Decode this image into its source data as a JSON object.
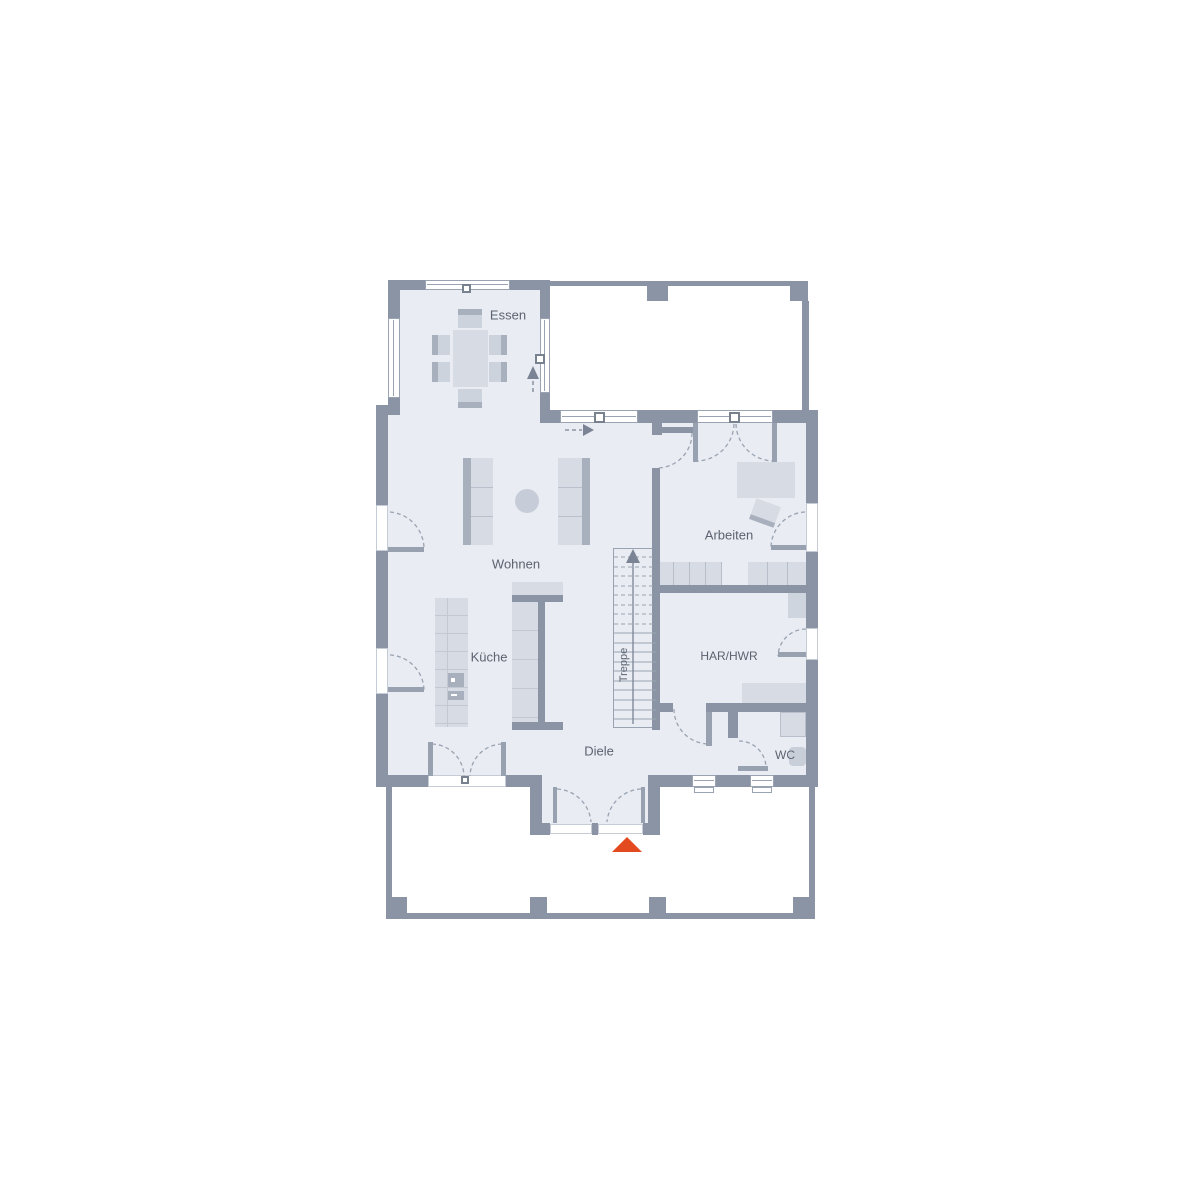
{
  "plan": {
    "rooms": {
      "essen": "Essen",
      "wohnen": "Wohnen",
      "kueche": "Küche",
      "arbeiten": "Arbeiten",
      "har_hwr": "HAR/HWR",
      "wc": "WC",
      "diele": "Diele",
      "treppe": "Treppe"
    },
    "icons": {
      "entrance_marker": "red-triangle-up",
      "stair_direction": "arrow-up",
      "essen_direction": "dashed-arrow-up",
      "wohnen_direction": "dashed-arrow-right"
    },
    "colors": {
      "wall": "#8b94a4",
      "floor": "#e9ecf2",
      "line": "#9aa3b2",
      "text": "#5c6370",
      "furniture_light": "#d7dbe3",
      "furniture_dark": "#a9b0bd",
      "entrance_marker": "#e44a20",
      "background": "#ffffff"
    }
  }
}
